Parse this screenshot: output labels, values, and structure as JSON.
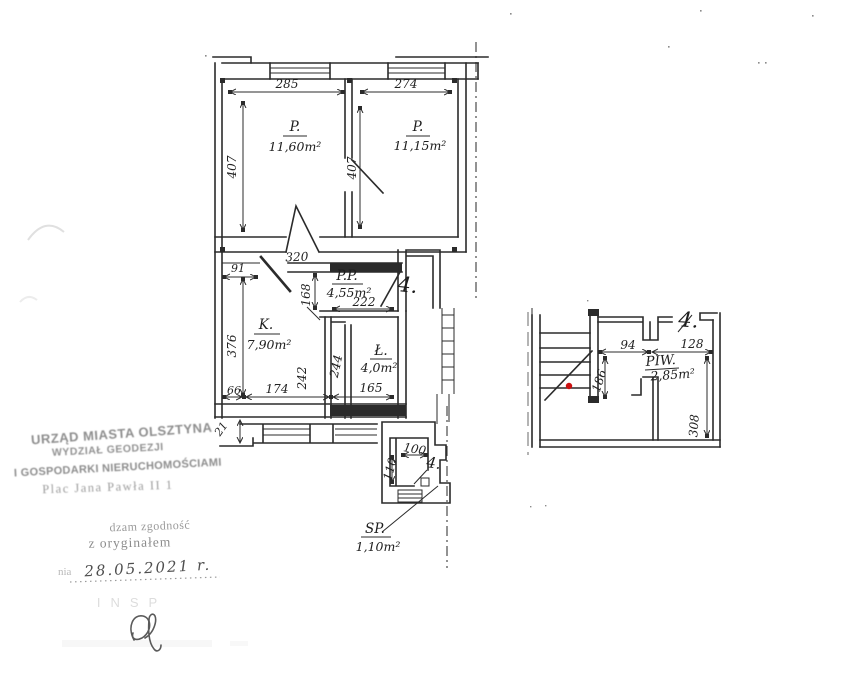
{
  "palette": {
    "ink": "#2b2b2b",
    "stamp_gray": "#8d8d8d",
    "red_dot": "#cc1111"
  },
  "plans": {
    "upper": {
      "room_left": {
        "name": "P.",
        "area": "11,60m²"
      },
      "room_right": {
        "name": "P.",
        "area": "11,15m²"
      },
      "dim_width_left": "285",
      "dim_width_right": "274",
      "dim_height_left": "407",
      "dim_height_mid": "407"
    },
    "middle": {
      "unit_number": "4.",
      "room_hall": {
        "name": "P.P.",
        "area": "4,55m²"
      },
      "room_kitchen": {
        "name": "K.",
        "area": "7,90m²"
      },
      "room_bath": {
        "name": "Ł.",
        "area": "4,0m²"
      },
      "dim_320": "320",
      "dim_91": "91",
      "dim_168": "168",
      "dim_222": "222",
      "dim_376": "376",
      "dim_242": "242",
      "dim_244": "244",
      "dim_66": "66",
      "dim_174": "174",
      "dim_165": "165",
      "dim_21": "21"
    },
    "annex": {
      "unit_number": "4.",
      "room_sp": {
        "name": "SP.",
        "area": "1,10m²"
      },
      "dim_100": "100",
      "dim_110": "110"
    },
    "basement": {
      "unit_number": "4.",
      "room_piw": {
        "name": "PIW.",
        "area": "2,85m²"
      },
      "dim_94": "94",
      "dim_128": "128",
      "dim_186": "186",
      "dim_308": "308"
    }
  },
  "stamp": {
    "line1": "URZĄD MIASTA OLSZTYNA",
    "line2": "WYDZIAŁ GEODEZJI",
    "line3": "I GOSPODARKI NIERUCHOMOŚCIAMI",
    "line4": "Plac Jana Pawła II 1"
  },
  "certification": {
    "fragment_line1": "dzam zgodność",
    "fragment_line2": "z oryginałem",
    "date_prefix": "nia",
    "date_value": "28.05.2021 r.",
    "faint_row": "INSP"
  }
}
